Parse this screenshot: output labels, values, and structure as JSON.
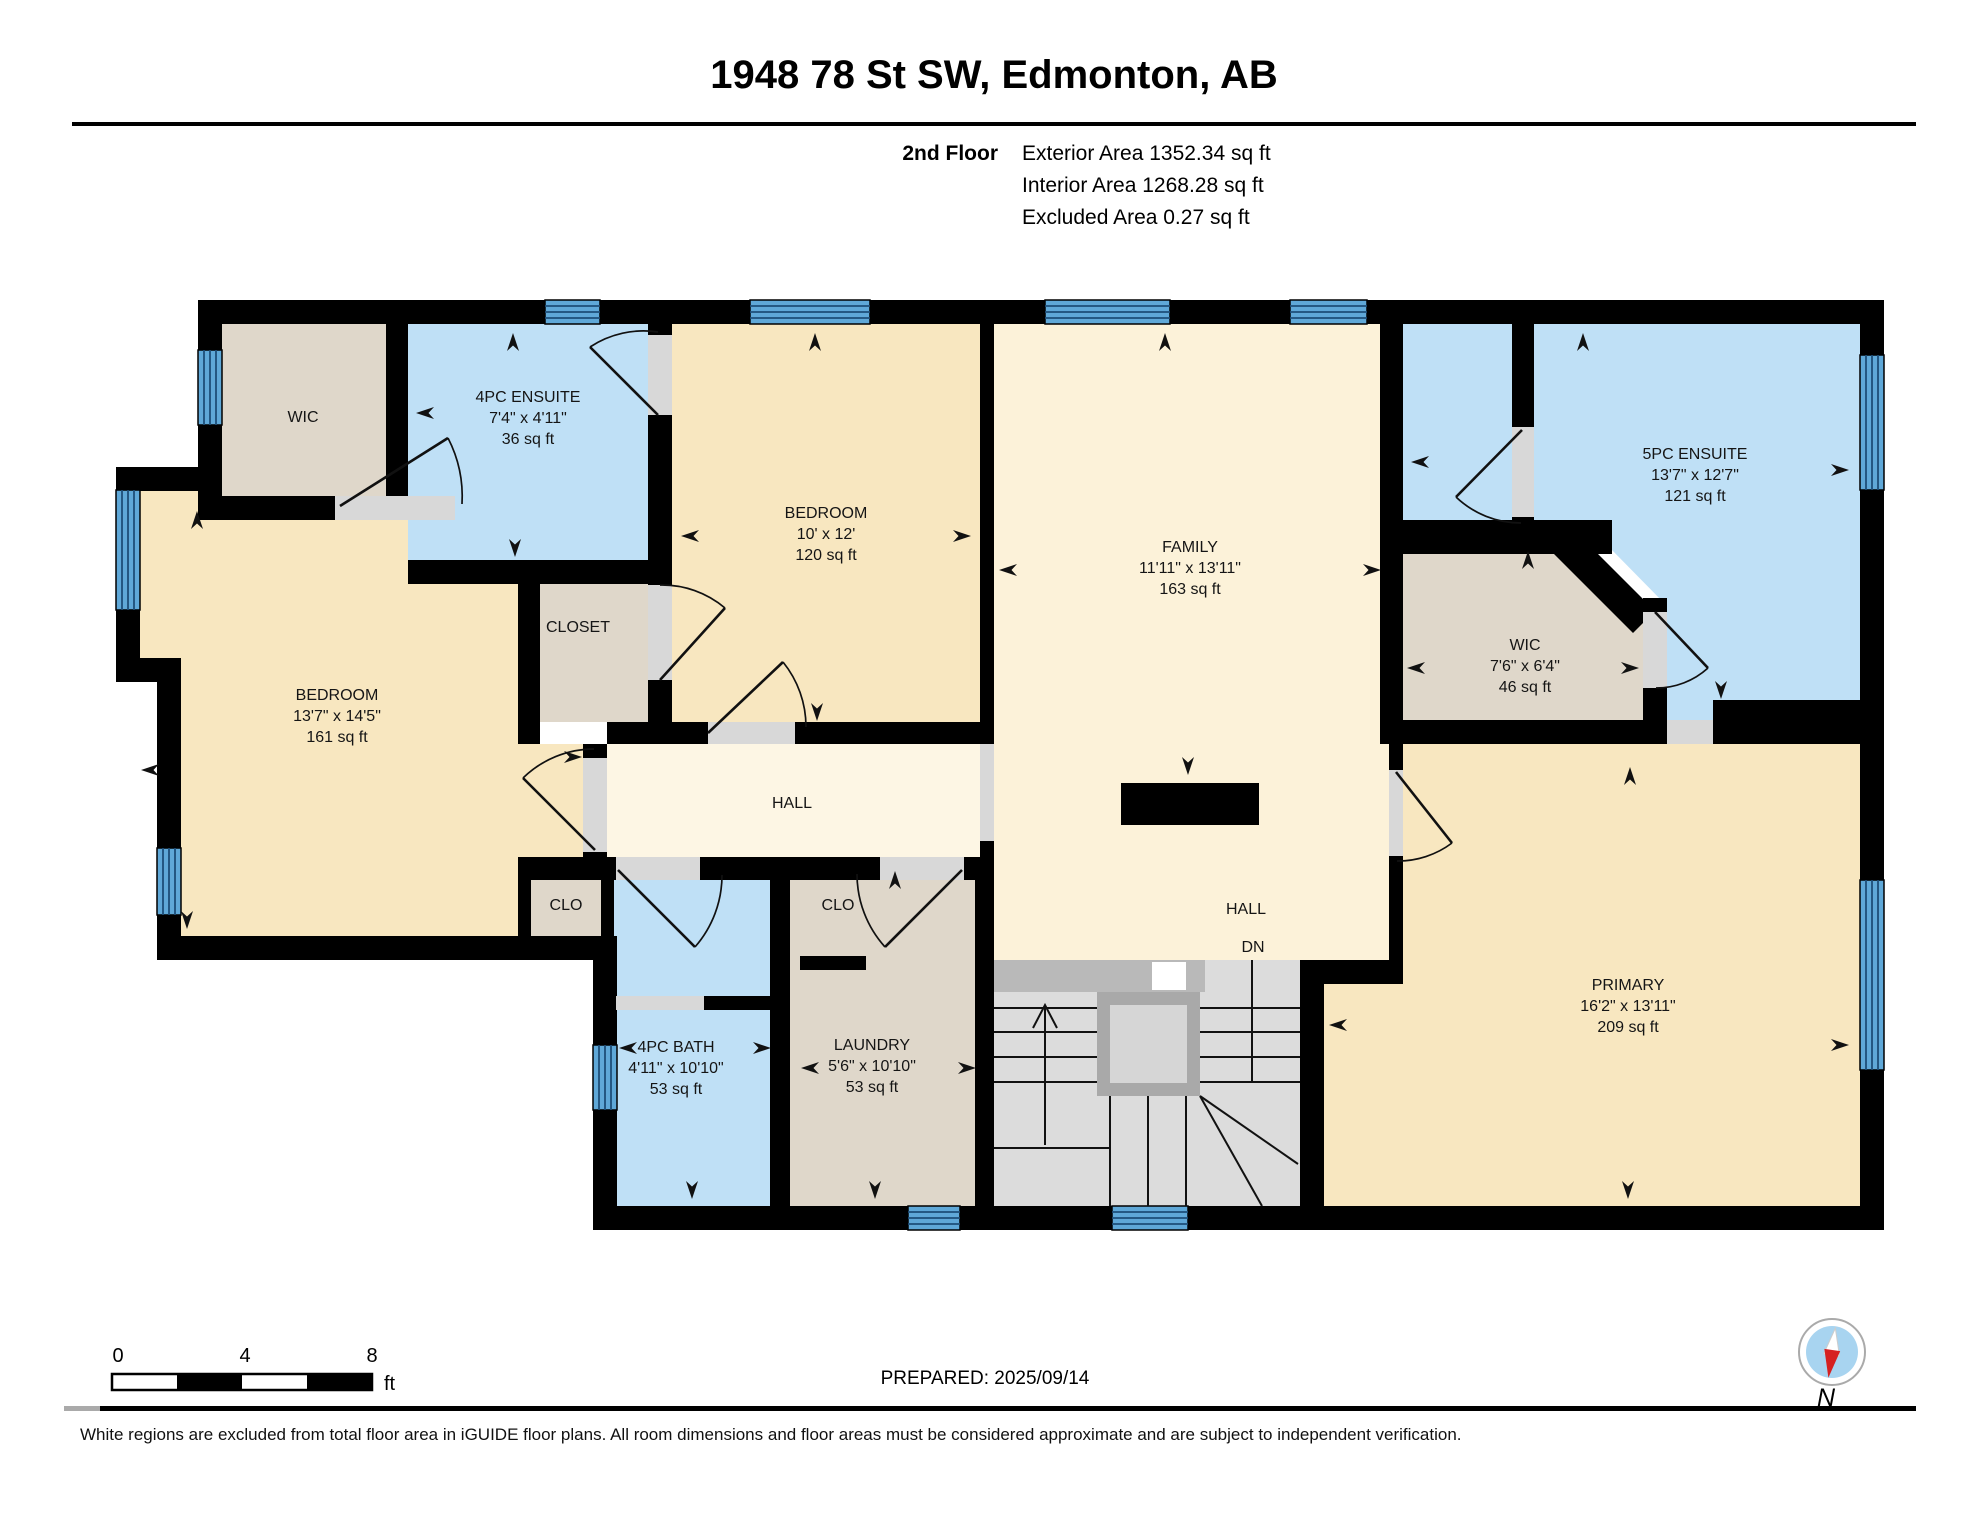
{
  "header": {
    "title": "1948 78 St SW, Edmonton, AB",
    "floor_label": "2nd Floor",
    "stats": [
      "Exterior Area 1352.34 sq ft",
      "Interior Area 1268.28 sq ft",
      "Excluded Area 0.27 sq ft"
    ]
  },
  "rooms": {
    "wic_left": {
      "name": "WIC"
    },
    "ensuite4": {
      "name": "4PC ENSUITE",
      "dims": "7'4\" x 4'11\"",
      "area": "36 sq ft"
    },
    "bedroom2": {
      "name": "BEDROOM",
      "dims": "10' x 12'",
      "area": "120 sq ft"
    },
    "family": {
      "name": "FAMILY",
      "dims": "11'11\" x 13'11\"",
      "area": "163 sq ft"
    },
    "ensuite5": {
      "name": "5PC ENSUITE",
      "dims": "13'7\" x 12'7\"",
      "area": "121 sq ft"
    },
    "wic_right": {
      "name": "WIC",
      "dims": "7'6\" x 6'4\"",
      "area": "46 sq ft"
    },
    "bedroom1": {
      "name": "BEDROOM",
      "dims": "13'7\" x 14'5\"",
      "area": "161 sq ft"
    },
    "closet": {
      "name": "CLOSET"
    },
    "hall1": {
      "name": "HALL"
    },
    "clo_left": {
      "name": "CLO"
    },
    "clo_right": {
      "name": "CLO"
    },
    "hall2": {
      "name": "HALL"
    },
    "stairs": {
      "down_label": "DN"
    },
    "bath": {
      "name": "4PC BATH",
      "dims": "4'11\" x 10'10\"",
      "area": "53 sq ft"
    },
    "laundry": {
      "name": "LAUNDRY",
      "dims": "5'6\" x 10'10\"",
      "area": "53 sq ft"
    },
    "primary": {
      "name": "PRIMARY",
      "dims": "16'2\" x 13'11\"",
      "area": "209 sq ft"
    }
  },
  "footer": {
    "scale": {
      "ticks": [
        "0",
        "4",
        "8"
      ],
      "unit": "ft"
    },
    "prepared": "PREPARED: 2025/09/14",
    "compass_label": "N",
    "disclaimer": "White regions are excluded from total floor area in iGUIDE floor plans. All room dimensions and floor areas must be considered approximate and are subject to independent verification."
  },
  "icons": {
    "compass": "compass-needle-icon",
    "dimension_arrow": "dimension-arrow-icon",
    "window": "window-icon",
    "door": "door-swing-icon",
    "stairs_up": "stairs-up-arrow-icon"
  },
  "palette": {
    "wall": "#000000",
    "room_yellow": "#F8E7C0",
    "room_cream": "#FCF2D9",
    "hall_cream": "#FDF6E4",
    "room_blue": "#BFE0F6",
    "room_tan": "#DFD7CA",
    "window_blue": "#5FA8D8",
    "stair_gray": "#DCDCDC",
    "door_gap": "#D8D8D8",
    "compass_red": "#D62020"
  }
}
